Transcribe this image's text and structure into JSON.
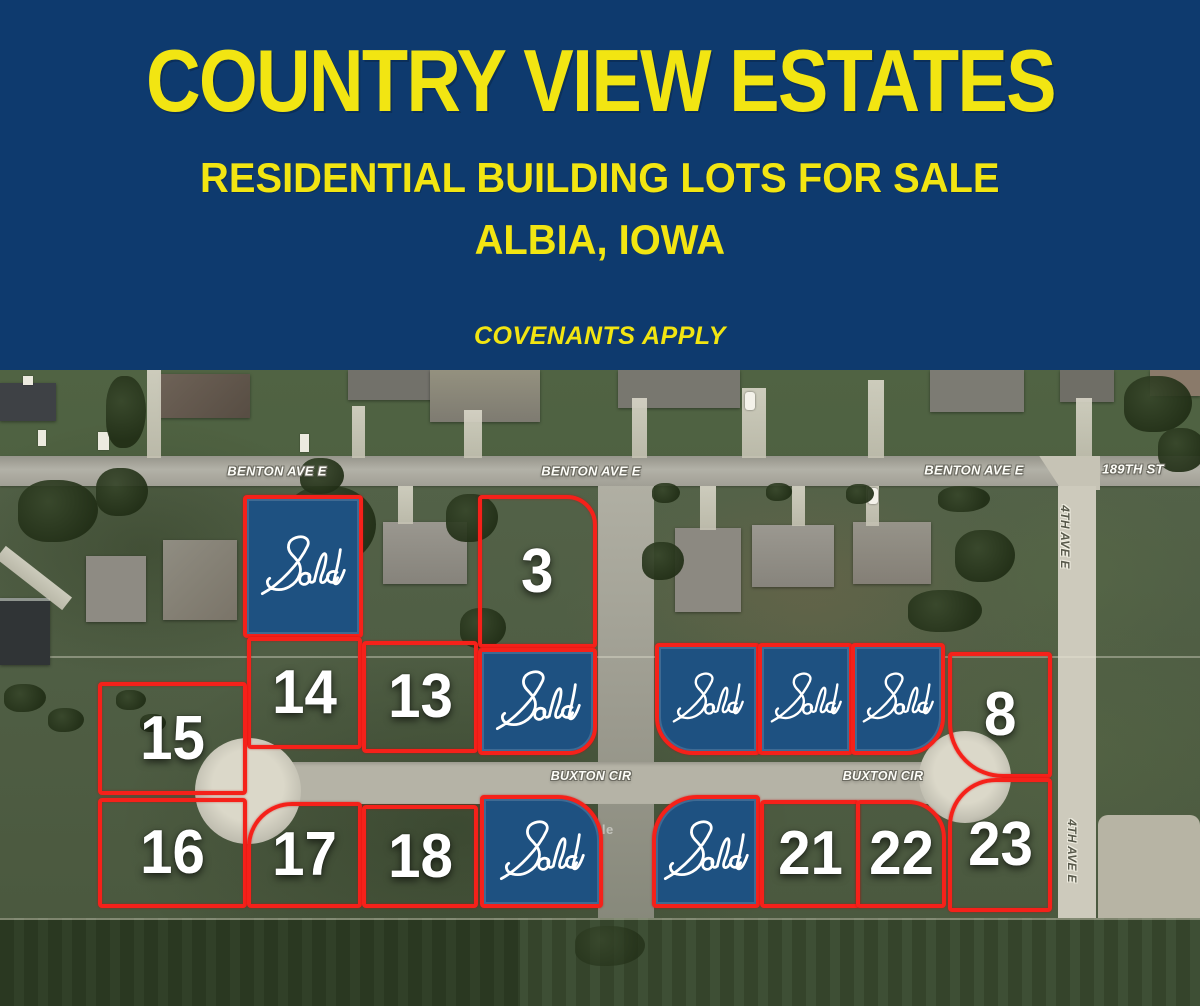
{
  "header": {
    "title": "COUNTRY VIEW ESTATES",
    "subtitle": "RESIDENTIAL BUILDING LOTS FOR SALE",
    "location": "ALBIA, IOWA",
    "note": "COVENANTS APPLY"
  },
  "map": {
    "street_labels": {
      "benton_1": "BENTON AVE E",
      "benton_2": "BENTON AVE E",
      "benton_3": "BENTON AVE E",
      "st_189": "189TH ST",
      "fourth_ave_north": "4TH AVE E",
      "fourth_ave_south": "4TH AVE E",
      "buxton_west": "BUXTON CIR",
      "buxton_east": "BUXTON CIR"
    },
    "watermark": "Google",
    "lots": {
      "sold_nw": "Sold",
      "lot_3": "3",
      "lot_14": "14",
      "lot_13": "13",
      "sold_mid": "Sold",
      "lot_15": "15",
      "sold_east_1": "Sold",
      "sold_east_2": "Sold",
      "sold_east_3": "Sold",
      "lot_8": "8",
      "lot_16": "16",
      "lot_17": "17",
      "lot_18": "18",
      "sold_south_1": "Sold",
      "sold_south_2": "Sold",
      "lot_21": "21",
      "lot_22": "22",
      "lot_23": "23"
    },
    "colors": {
      "sold_fill": "#1e5181",
      "lot_outline": "#f5211a"
    }
  },
  "colors": {
    "header_bg": "#0e3a6e",
    "accent_yellow": "#f2e512"
  }
}
